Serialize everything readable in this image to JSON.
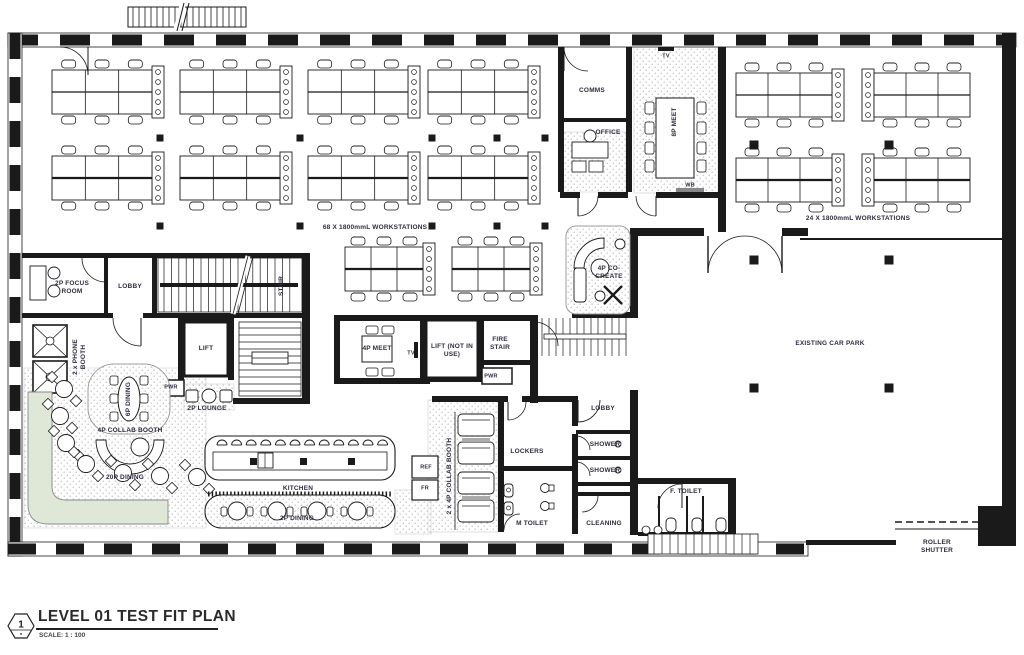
{
  "meta": {
    "drawing_type": "architectural test fit floor plan",
    "colors": {
      "ink": "#1a1a1a",
      "label": "#2c2c3e",
      "banquette_green": "#dfe7d6",
      "dot": "#b9b9b9",
      "paper": "#ffffff"
    }
  },
  "title_block": {
    "sheet_number": "1",
    "title": "LEVEL 01 TEST FIT PLAN",
    "scale": "SCALE:  1 : 100"
  },
  "labels": {
    "comms": "COMMS",
    "office": "OFFICE",
    "meet8p": "8P MEET",
    "tv1": "TV",
    "wb": "WB",
    "ws68": "68 X 1800mmL WORKSTATIONS",
    "ws24": "24 X 1800mmL WORKSTATIONS",
    "focus2p": "2P FOCUS ROOM",
    "lobby1": "LOBBY",
    "stair": "STAIR",
    "phone": "2 x PHONE BOOTH",
    "lift": "LIFT",
    "pwr1": "PWR",
    "lounge2p": "2P LOUNGE",
    "dining6p": "6P DINING",
    "collab4p": "4P COLLAB BOOTH",
    "dining20p": "20P DINING",
    "kitchen": "KITCHEN",
    "dining2p": "2P DINING",
    "ref": "REF",
    "fr": "FR",
    "collab2x4p": "2 x 4P COLLAB BOOTH",
    "lockers": "LOCKERS",
    "mtoilet": "M TOILET",
    "lobby2": "LOBBY",
    "shower1": "SHOWER",
    "shower2": "SHOWER",
    "cleaning": "CLEANING",
    "ftoilet": "F. TOILET",
    "cocreate": "4P CO-CREATE",
    "meet4p": "4P MEET",
    "tv2": "TV",
    "liftniu": "LIFT (NOT IN USE)",
    "firestair": "FIRE STAIR",
    "pwr2": "PWR",
    "carpark": "EXISTING CAR PARK",
    "roller": "ROLLER SHUTTER"
  }
}
